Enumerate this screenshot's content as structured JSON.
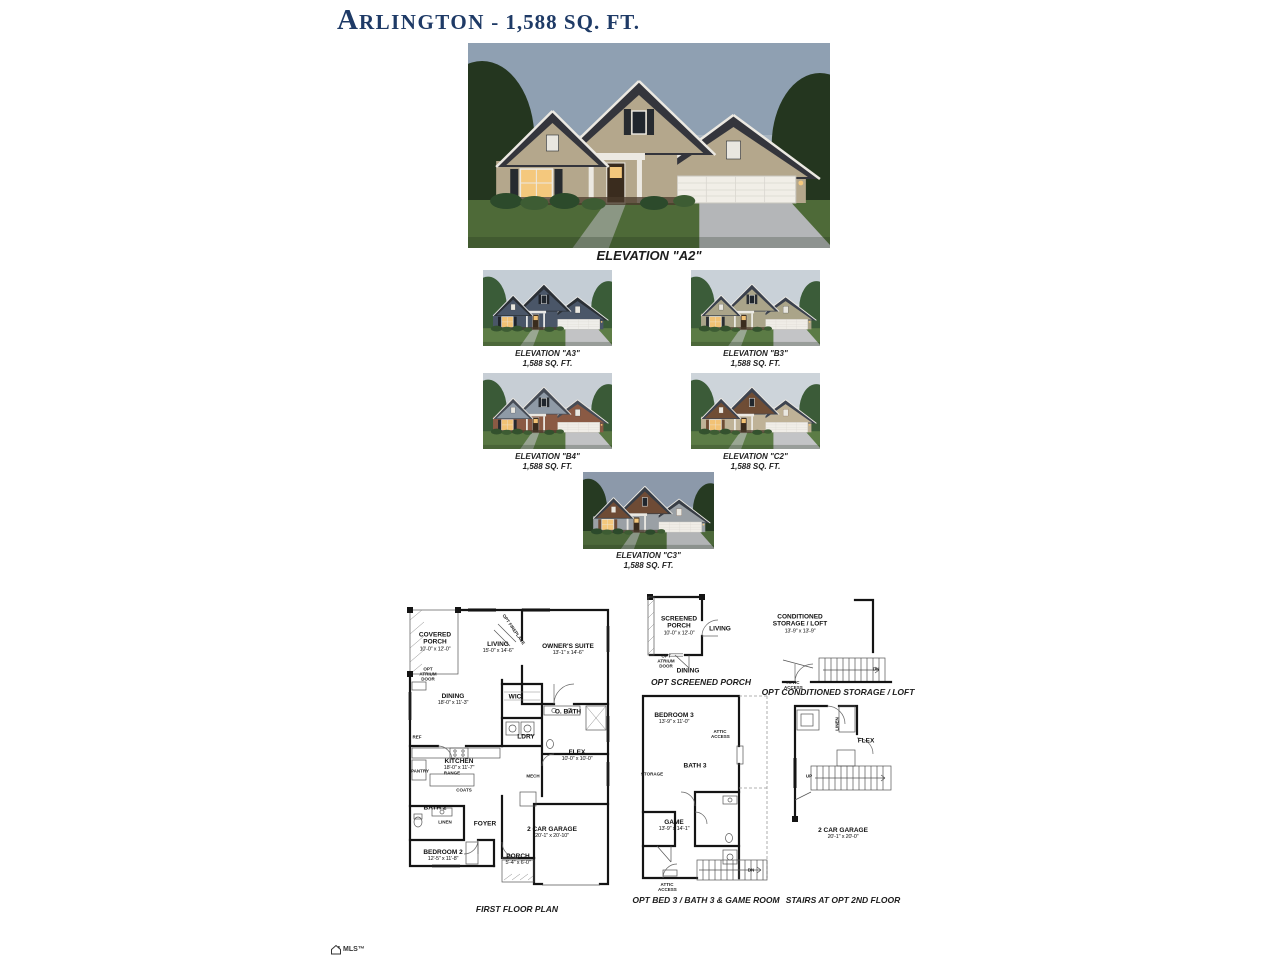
{
  "title": {
    "initial": "A",
    "name_rest": "RLINGTON",
    "suffix": " - 1,588 SQ. FT."
  },
  "main_elevation": {
    "caption": "ELEVATION \"A2\""
  },
  "thumbnails": [
    {
      "caption": "ELEVATION \"A3\"",
      "sqft": "1,588 SQ. FT."
    },
    {
      "caption": "ELEVATION \"B3\"",
      "sqft": "1,588 SQ. FT."
    },
    {
      "caption": "ELEVATION \"B4\"",
      "sqft": "1,588 SQ. FT."
    },
    {
      "caption": "ELEVATION \"C2\"",
      "sqft": "1,588 SQ. FT."
    },
    {
      "caption": "ELEVATION \"C3\"",
      "sqft": "1,588 SQ. FT."
    }
  ],
  "first_floor": {
    "caption": "FIRST FLOOR PLAN",
    "covered_porch": {
      "name": "COVERED PORCH",
      "dims": "10'-0\" x 12'-0\""
    },
    "living": {
      "name": "LIVING",
      "dims": "15'-0\" x 14'-6\""
    },
    "owners_suite": {
      "name": "OWNER'S SUITE",
      "dims": "13'-1\" x 14'-6\""
    },
    "dining": {
      "name": "DINING",
      "dims": "18'-0\" x 11'-3\""
    },
    "wic": {
      "name": "WIC"
    },
    "obath": {
      "name": "O. BATH"
    },
    "ldry": {
      "name": "LDRY"
    },
    "flex": {
      "name": "FLEX",
      "dims": "10'-0\" x 10'-0\""
    },
    "kitchen": {
      "name": "KITCHEN",
      "dims": "18'-0\" x 11'-7\""
    },
    "bath2": {
      "name": "BATH 2"
    },
    "foyer": {
      "name": "FOYER"
    },
    "garage": {
      "name": "2 CAR GARAGE",
      "dims": "20'-1\" x 20'-10\""
    },
    "bedroom2": {
      "name": "BEDROOM 2",
      "dims": "12'-5\" x 11'-8\""
    },
    "porch": {
      "name": "PORCH",
      "dims": "5'-4\" x 6'-0\""
    },
    "small": {
      "ref": "REF",
      "pantry": "PANTRY",
      "range": "RANGE",
      "coats": "COATS",
      "linen": "LINEN",
      "mech": "MECH",
      "opt_fireplace": "OPT FIREPLACE",
      "opt_atrium_door": "OPT ATRIUM DOOR"
    }
  },
  "opt_screened_porch": {
    "caption": "OPT SCREENED PORCH",
    "screened_porch": {
      "name": "SCREENED PORCH",
      "dims": "10'-0\" x 12'-0\""
    },
    "living": {
      "name": "LIVING"
    },
    "dining": {
      "name": "DINING"
    },
    "small": {
      "opt_atrium_door": "OPT ATRIUM DOOR"
    }
  },
  "opt_storage": {
    "caption": "OPT CONDITIONED STORAGE / LOFT",
    "storage": {
      "name": "CONDITIONED STORAGE / LOFT",
      "dims": "13'-9\" x 13'-9\""
    },
    "small": {
      "attic_access": "ATTIC ACCESS",
      "dn": "DN"
    }
  },
  "opt_bed3": {
    "caption": "OPT BED 3 / BATH 3 & GAME ROOM",
    "bedroom3": {
      "name": "BEDROOM 3",
      "dims": "13'-9\" x 11'-0\""
    },
    "bath3": {
      "name": "BATH 3"
    },
    "game": {
      "name": "GAME",
      "dims": "13'-9\" x 14'-1\""
    },
    "small": {
      "storage": "STORAGE",
      "attic_access": "ATTIC ACCESS",
      "dn": "DN"
    }
  },
  "opt_stairs": {
    "caption": "STAIRS AT OPT 2ND FLOOR",
    "flex": {
      "name": "FLEX"
    },
    "garage": {
      "name": "2 CAR GARAGE",
      "dims": "20'-1\" x 20'-0\""
    },
    "small": {
      "linen": "LINEN",
      "up": "UP"
    }
  },
  "logo": {
    "text": "MLS™"
  },
  "colors": {
    "title_text": "#1e3a66",
    "sky_dusk": "#8fa0b2",
    "siding_tan": "#b4a78c",
    "roof_dark": "#34353c",
    "garage_door_white": "#f1eee7",
    "lawn_green": "#4e6a38",
    "window_glow": "#f4c87d",
    "plan_line": "#141414"
  }
}
